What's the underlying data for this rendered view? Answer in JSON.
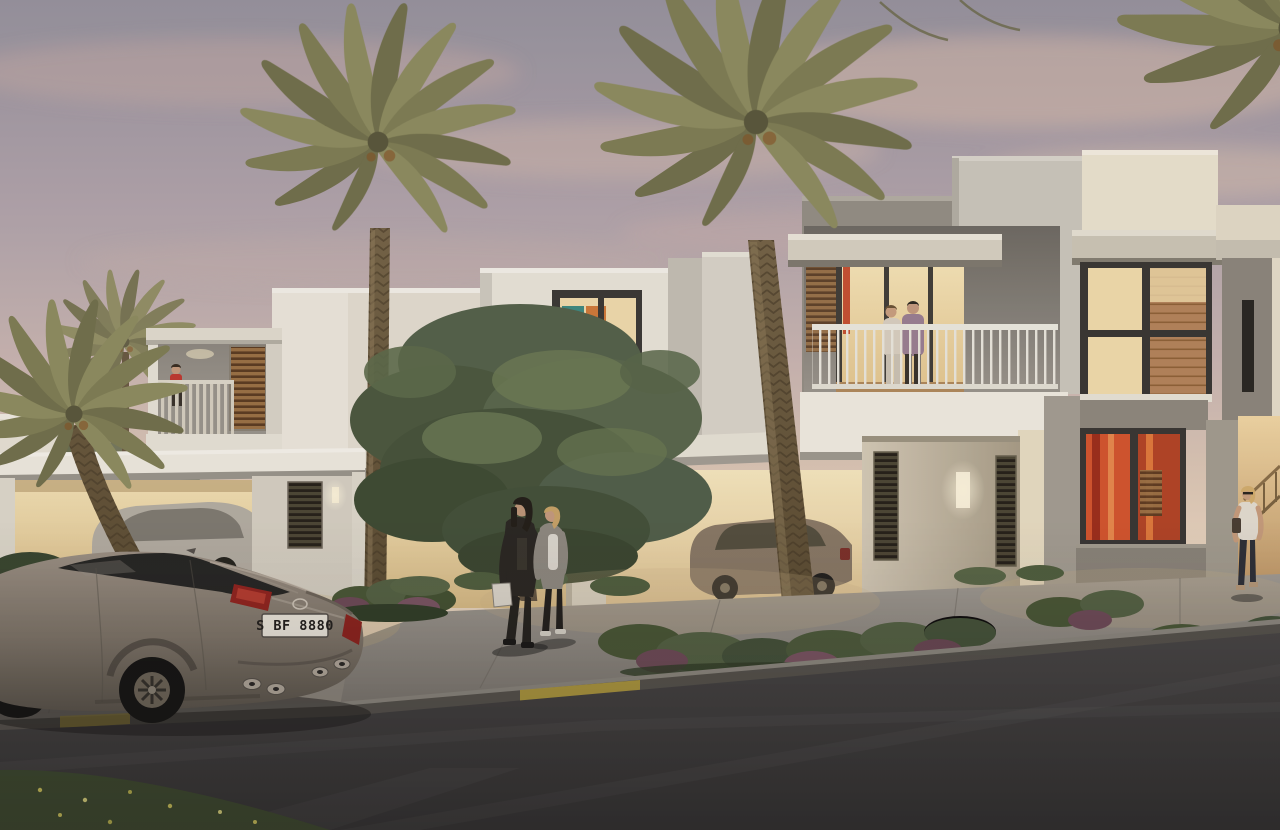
{
  "scene": {
    "type": "architectural-rendering",
    "time_of_day": "dusk",
    "description": "Modern white two-storey townhouse row with palm trees, landscaped walkway, pedestrians and a parked sedan on the street",
    "palette": {
      "sky_top": "#97939e",
      "sky_horizon": "#e9d6bf",
      "cloud": "#e6c3ac",
      "wall_light": "#ebe6da",
      "wall_shadow": "#b7b3a9",
      "interior_glow": "#f4e2b4",
      "window_frame": "#3a3834",
      "wood": "#b4845a",
      "palm_frond": "#84835a",
      "palm_trunk": "#6e5d43",
      "tree_foliage": "#55624a",
      "shrub_green": "#4a5836",
      "shrub_purple": "#6f4c58",
      "sidewalk": "#97928a",
      "road": "#434140",
      "curb_yellow": "#b9a23e",
      "grass": "#3e4a2f",
      "car_body": "#8a8178",
      "tail_light": "#a3322a",
      "plate_background": "#ece8dc"
    },
    "buildings": [
      {
        "id": "left-townhouse",
        "features": [
          "projecting balcony with slat railing",
          "child figure on balcony",
          "wood louver window",
          "recessed downlight",
          "warm lit double carport",
          "parked silver sedan",
          "louvered vent",
          "wall sconce"
        ]
      },
      {
        "id": "middle-townhouse",
        "features": [
          "upper window with colourful glass artwork",
          "stepped parapet walls",
          "carport with parked champagne sedan"
        ]
      },
      {
        "id": "right-townhouse",
        "features": [
          "roof terrace with standing couple",
          "white balustrade railing",
          "concrete cornices",
          "orange accented doorway",
          "tall window with timber interior",
          "lower window with orange abstract art",
          "louvered entry pillar with lit sconce",
          "slit-window fin wall",
          "warm side passage",
          "carport with parked bronze sedan"
        ]
      }
    ],
    "vegetation": {
      "palm_trees": 5,
      "deciduous_trees": 1,
      "shrub_beds": "mixed green and burgundy shrubs",
      "flowers": "pink and yellow accents",
      "grass_verge": "bottom-left corner with small yellow flowers"
    },
    "vehicles": {
      "foreground_car": {
        "type": "sedan",
        "brand_badge": "Lexus",
        "license_plate": "S BF 8880",
        "details": [
          "red tail lights",
          "quad exhaust tips",
          "alloy wheels"
        ]
      },
      "parked_cars": [
        "silver sedan in left carport",
        "champagne sedan in middle carport",
        "bronze sedan in right carport"
      ]
    },
    "people": [
      {
        "id": "walking-couple",
        "location": "front walkway",
        "details": "man in dark jacket carrying white bag, woman in grey cardigan and jeans"
      },
      {
        "id": "terrace-couple",
        "location": "first-floor terrace"
      },
      {
        "id": "balcony-child",
        "location": "left balcony",
        "details": "red outfit"
      },
      {
        "id": "passage-woman",
        "location": "right side passage",
        "details": "white top, jeans, shoulder bag"
      }
    ],
    "street": {
      "curb_markings": "yellow painted curb segments",
      "surfaces": [
        "asphalt road",
        "concrete walkway",
        "driveway"
      ]
    }
  }
}
